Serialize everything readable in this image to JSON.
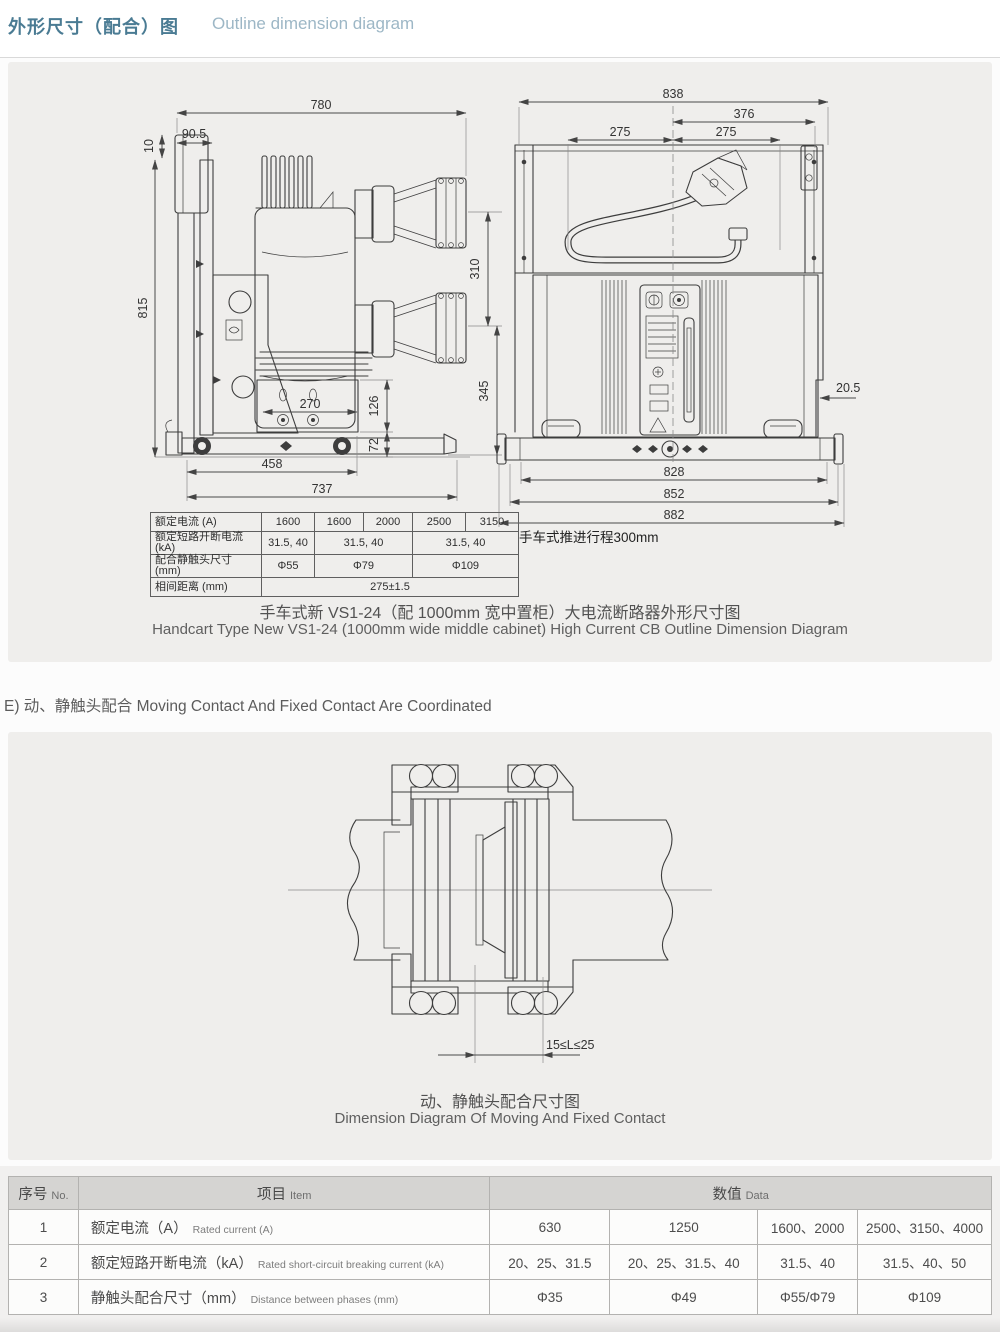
{
  "header": {
    "title_zh": "外形尺寸（配合）图",
    "title_en": "Outline dimension diagram"
  },
  "drawing1": {
    "side_view_dims": {
      "w780": "780",
      "w90_5": "90.5",
      "h10": "10",
      "h815": "815",
      "h310": "310",
      "h345": "345",
      "w270": "270",
      "h126": "126",
      "h72": "72",
      "w458": "458",
      "w737": "737"
    },
    "front_view_dims": {
      "w838": "838",
      "w376": "376",
      "w275l": "275",
      "w275r": "275",
      "w20_5": "20.5",
      "w828": "828",
      "w852": "852",
      "w882": "882"
    },
    "travel_note": "手车式推进行程300mm",
    "caption_zh": "手车式新 VS1-24（配 1000mm 宽中置柜）大电流断路器外形尺寸图",
    "caption_en": "Handcart Type New VS1-24 (1000mm wide middle cabinet) High Current CB Outline Dimension Diagram"
  },
  "spec_table": {
    "rows": [
      {
        "label": "额定电流 (A)",
        "cells": [
          "1600",
          "1600",
          "2000",
          "2500",
          "3150"
        ]
      },
      {
        "label": "额定短路开断电流 (kA)",
        "cells": [
          "31.5, 40",
          "31.5, 40",
          "31.5, 40"
        ]
      },
      {
        "label": "配合静触头尺寸 (mm)",
        "cells": [
          "Φ55",
          "Φ79",
          "Φ109"
        ]
      },
      {
        "label": "相间距离 (mm)",
        "cells": [
          "275±1.5"
        ]
      }
    ]
  },
  "section_e": {
    "heading": "E) 动、静触头配合 Moving Contact And Fixed Contact Are Coordinated",
    "dim_label": "15≤L≤25",
    "caption_zh": "动、静触头配合尺寸图",
    "caption_en": "Dimension Diagram Of Moving And Fixed Contact"
  },
  "big_table": {
    "headers": {
      "no_zh": "序号",
      "no_en": "No.",
      "item_zh": "项目",
      "item_en": "Item",
      "data_zh": "数值",
      "data_en": "Data"
    },
    "rows": [
      {
        "no": "1",
        "item_zh": "额定电流（A）",
        "item_en": "Rated current (A)",
        "values": [
          "630",
          "1250",
          "1600、2000",
          "2500、3150、4000"
        ]
      },
      {
        "no": "2",
        "item_zh": "额定短路开断电流（kA）",
        "item_en": "Rated short-circuit breaking current (kA)",
        "values": [
          "20、25、31.5",
          "20、25、31.5、40",
          "31.5、40",
          "31.5、40、50"
        ]
      },
      {
        "no": "3",
        "item_zh": "静触头配合尺寸（mm）",
        "item_en": "Distance between phases (mm)",
        "values": [
          "Φ35",
          "Φ49",
          "Φ55/Φ79",
          "Φ109"
        ]
      }
    ]
  }
}
